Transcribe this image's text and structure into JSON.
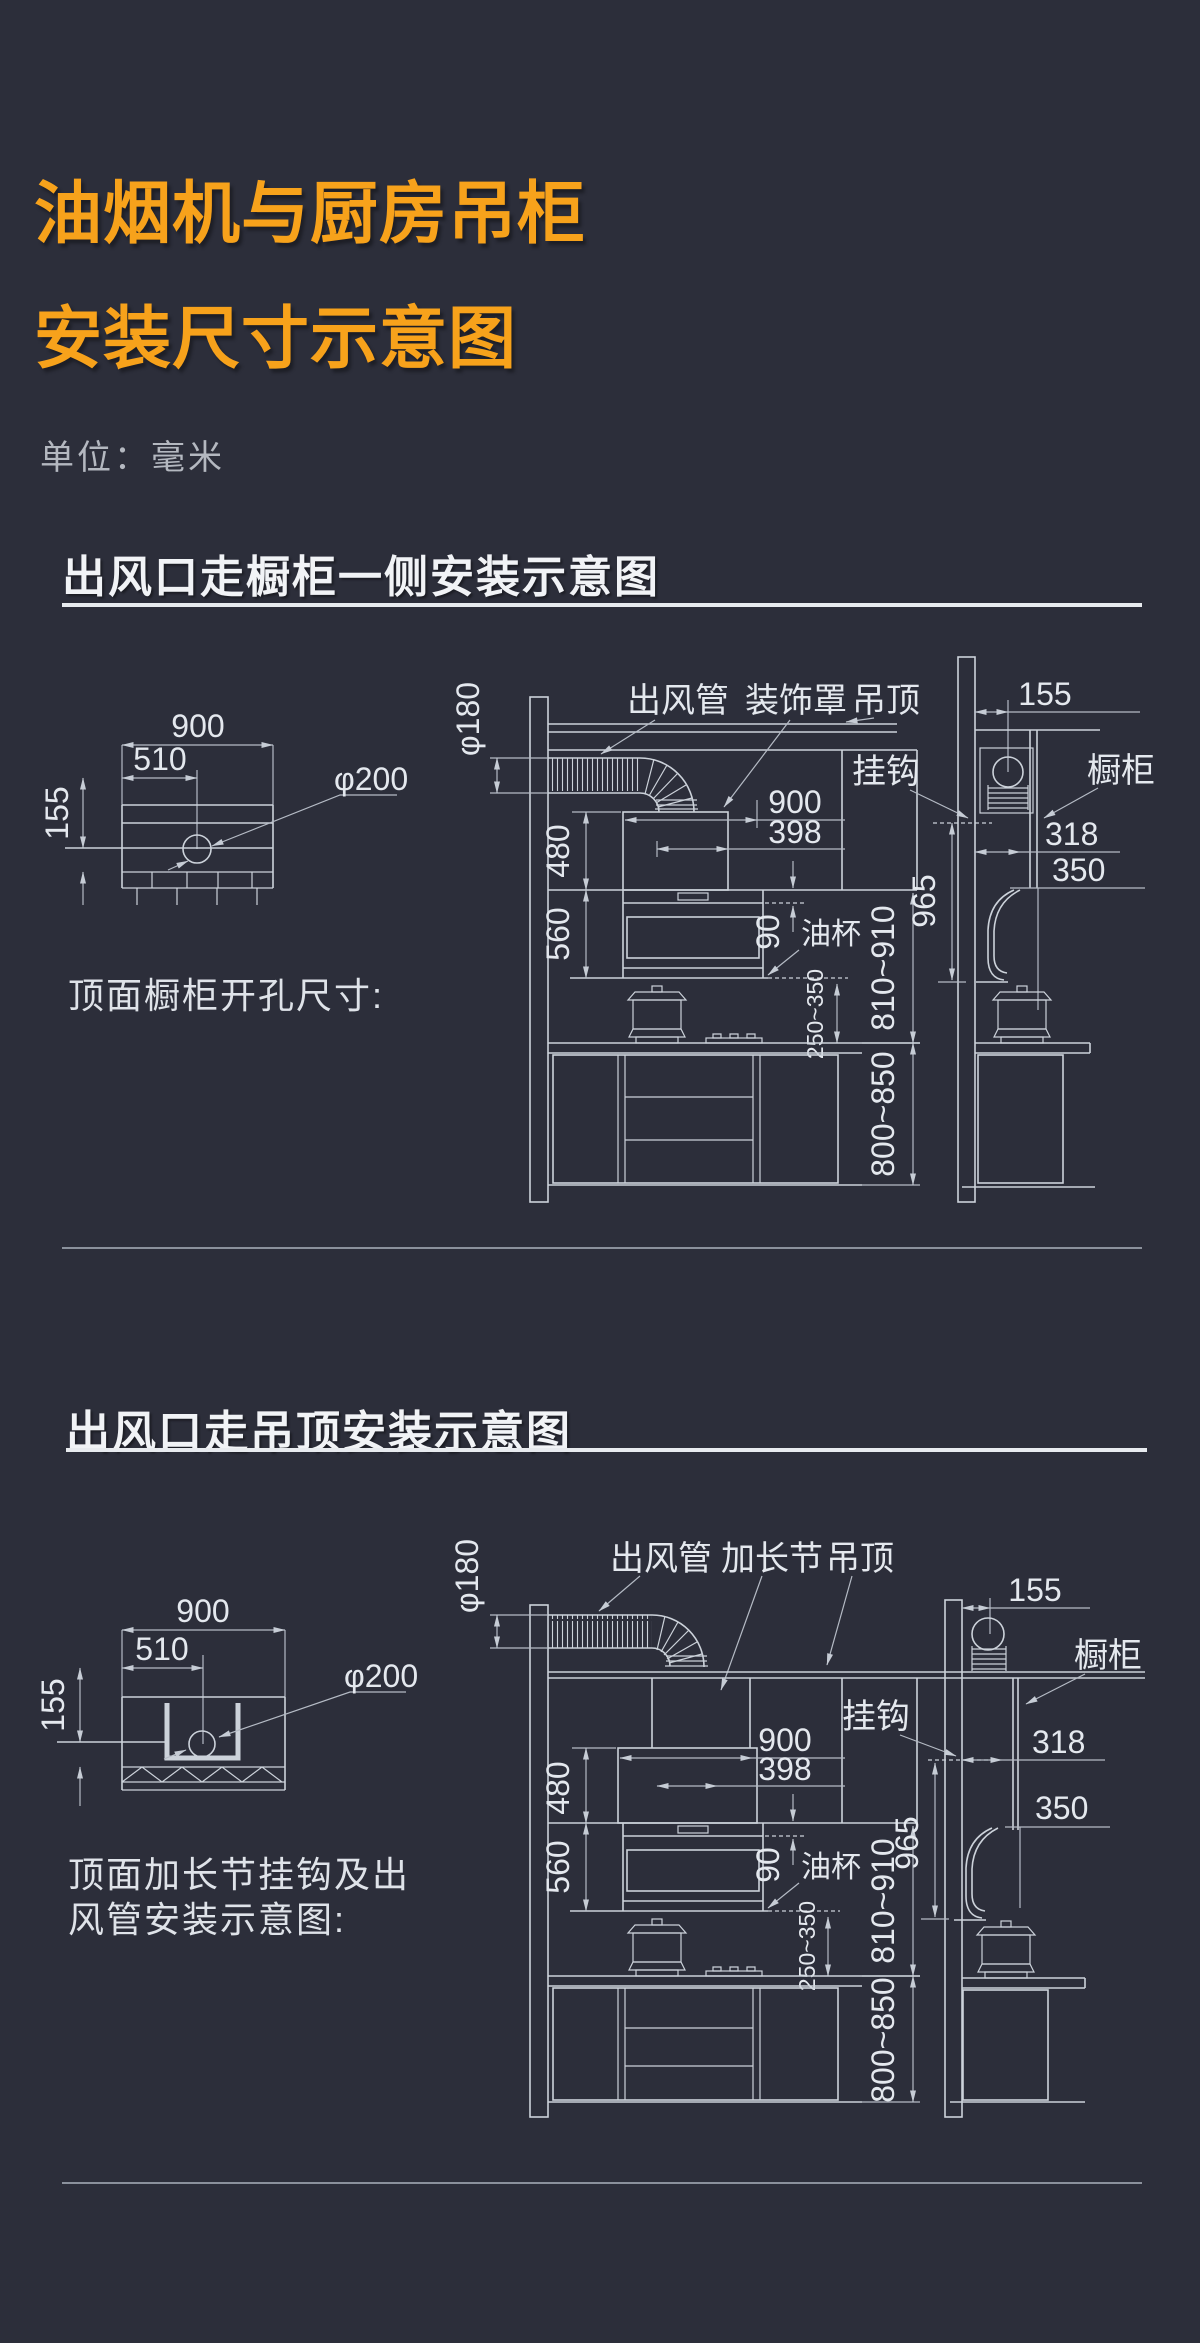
{
  "page": {
    "title_line1": "油烟机与厨房吊柜",
    "title_line2": "安装尺寸示意图",
    "unit_label": "单位：毫米",
    "colors": {
      "background": "#2c2e3a",
      "accent_orange": "#f7a21b",
      "line": "#ccd2da",
      "text": "#e4e8ee"
    }
  },
  "section1": {
    "heading": "出风口走橱柜一侧安装示意图",
    "plan": {
      "dim_width": "900",
      "dim_inner_width": "510",
      "dim_height": "155",
      "dim_hole_dia": "φ200",
      "caption": "顶面橱柜开孔尺寸:"
    },
    "front": {
      "label_duct": "出风管",
      "label_cover": "装饰罩",
      "label_ceiling": "吊顶",
      "label_oil_cup": "油杯",
      "dim_duct_dia": "φ180",
      "dim_cover_width": "900",
      "dim_body_width": "398",
      "dim_cover_height": "480",
      "dim_body_height": "560",
      "dim_oil_cup": "90",
      "dim_hob_clearance": "250~350",
      "dim_hood_range": "810~910",
      "dim_counter_range": "800~850"
    },
    "side": {
      "label_hook": "挂钩",
      "label_cabinet": "橱柜",
      "dim_offset": "155",
      "dim_depth": "318",
      "dim_front": "350",
      "dim_hook_height": "965"
    }
  },
  "section2": {
    "heading": "出风口走吊顶安装示意图",
    "plan": {
      "dim_width": "900",
      "dim_inner_width": "510",
      "dim_height": "155",
      "dim_hole_dia": "φ200",
      "caption_line1": "顶面加长节挂钩及出",
      "caption_line2": "风管安装示意图:"
    },
    "front": {
      "label_duct": "出风管",
      "label_extension": "加长节",
      "label_ceiling": "吊顶",
      "label_oil_cup": "油杯",
      "dim_duct_dia": "φ180",
      "dim_cover_width": "900",
      "dim_body_width": "398",
      "dim_cover_height": "480",
      "dim_body_height": "560",
      "dim_oil_cup": "90",
      "dim_hob_clearance": "250~350",
      "dim_hood_range": "810~910",
      "dim_counter_range": "800~850"
    },
    "side": {
      "label_hook": "挂钩",
      "label_cabinet": "橱柜",
      "dim_offset": "155",
      "dim_depth": "318",
      "dim_front": "350",
      "dim_hook_height": "965"
    }
  }
}
